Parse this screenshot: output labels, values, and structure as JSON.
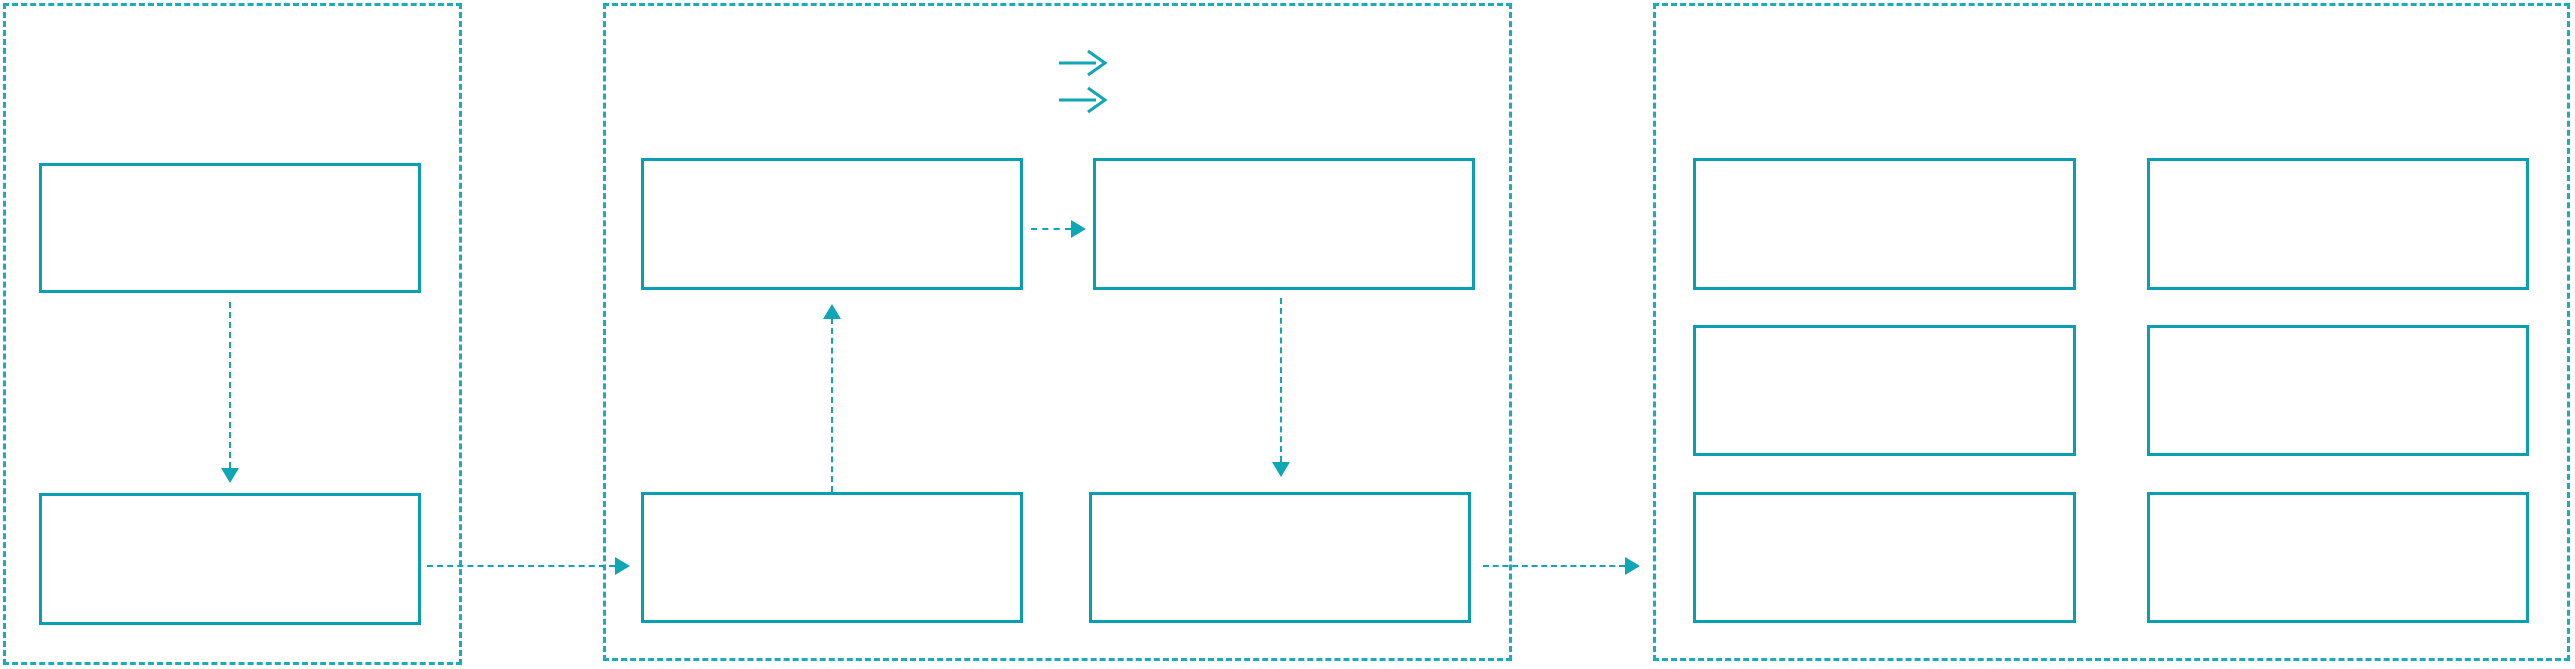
{
  "diagram": {
    "type": "flow-wireframe",
    "background": "#ffffff",
    "colors": {
      "box_border": "#0a9fb0",
      "frame_border": "#1aabbc",
      "arrow": "#0fa6b6",
      "background": "#ffffff"
    },
    "icons": [
      {
        "name": "double-right-arrow-icon",
        "glyph": "→→",
        "description": "two stacked right arrows",
        "location": "middle panel, top center"
      }
    ],
    "panels": [
      {
        "id": "left",
        "border_style": "dashed",
        "boxes": [
          {
            "id": "left-box-1",
            "label": ""
          },
          {
            "id": "left-box-2",
            "label": ""
          }
        ]
      },
      {
        "id": "middle",
        "border_style": "dashed",
        "boxes": [
          {
            "id": "middle-box-top-left",
            "label": ""
          },
          {
            "id": "middle-box-top-right",
            "label": ""
          },
          {
            "id": "middle-box-bottom-left",
            "label": ""
          },
          {
            "id": "middle-box-bottom-right",
            "label": ""
          }
        ]
      },
      {
        "id": "right",
        "border_style": "dashed",
        "boxes": [
          {
            "id": "right-box-row1-col1",
            "label": ""
          },
          {
            "id": "right-box-row1-col2",
            "label": ""
          },
          {
            "id": "right-box-row2-col1",
            "label": ""
          },
          {
            "id": "right-box-row2-col2",
            "label": ""
          },
          {
            "id": "right-box-row3-col1",
            "label": ""
          },
          {
            "id": "right-box-row3-col2",
            "label": ""
          }
        ]
      }
    ],
    "connectors": [
      {
        "from": "left-box-1",
        "to": "left-box-2",
        "direction": "down",
        "style": "dashed"
      },
      {
        "from": "left-box-2",
        "to": "middle-box-bottom-left",
        "direction": "right",
        "style": "dashed"
      },
      {
        "from": "middle-box-bottom-left",
        "to": "middle-box-top-left",
        "direction": "up",
        "style": "dashed"
      },
      {
        "from": "middle-box-top-left",
        "to": "middle-box-top-right",
        "direction": "right",
        "style": "dashed"
      },
      {
        "from": "middle-box-top-right",
        "to": "middle-box-bottom-right",
        "direction": "down",
        "style": "dashed"
      },
      {
        "from": "middle-box-bottom-right",
        "to": "right-panel",
        "direction": "right",
        "style": "dashed"
      }
    ]
  }
}
